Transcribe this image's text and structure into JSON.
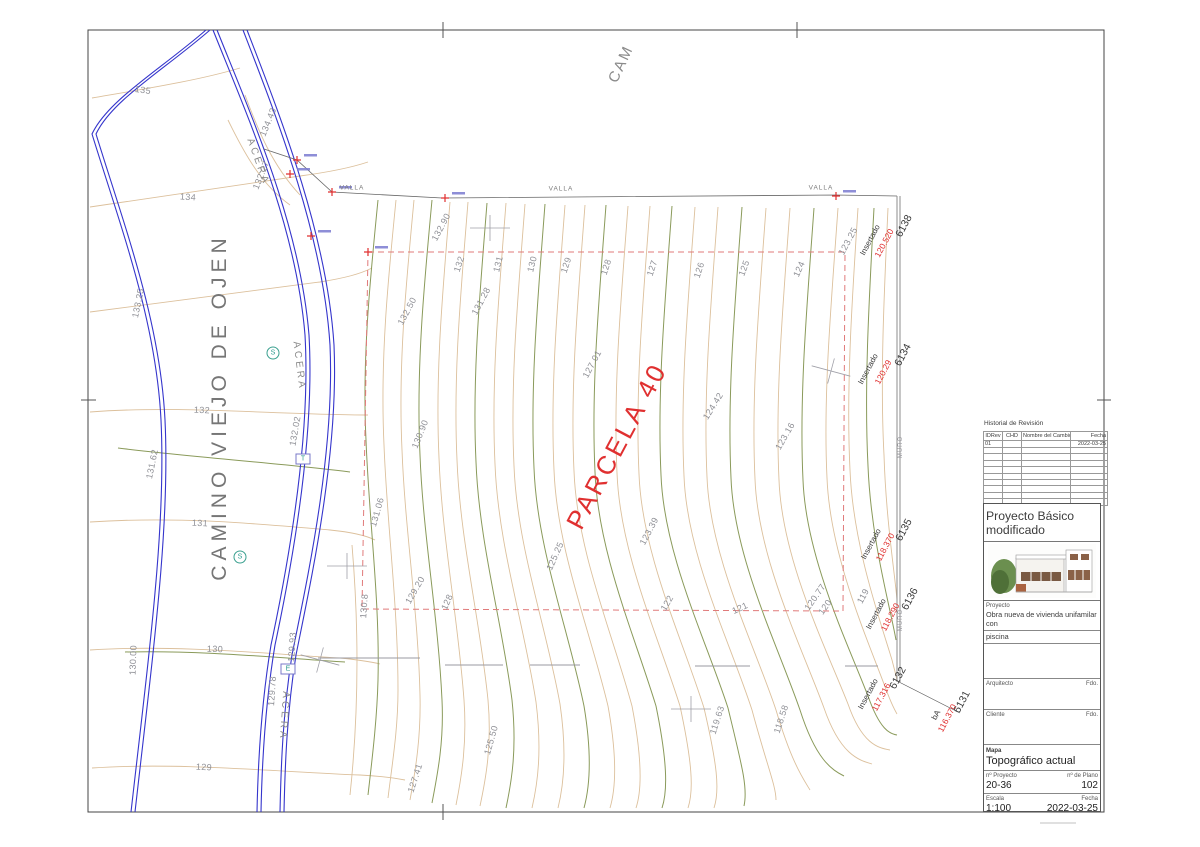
{
  "colors": {
    "contour_minor": "#dcc09c",
    "contour_major": "#8a9a5a",
    "road_blue": "#3535cc",
    "boundary_red": "#e07a7a",
    "red_text": "#e03030",
    "gray_text": "#8f9096"
  },
  "title_block": {
    "revision": {
      "title": "Historial de Revisión",
      "columns": [
        "IDRev",
        "CHD",
        "Nombre del Cambio",
        "Fecha"
      ],
      "row1": {
        "id": "01",
        "chd": "",
        "name": "",
        "date": "2022-03-25"
      }
    },
    "project_title": "Proyecto Básico modificado",
    "project_label": "Proyecto",
    "project_desc_line1": "Obra nueva de vivienda unifamilar con",
    "project_desc_line2": "piscina",
    "architect_label": "Arquitecto",
    "architect_sign": "Fdo.",
    "client_label": "Cliente",
    "client_sign": "Fdo.",
    "sheet_label": "Mapa",
    "sheet_title": "Topográfico actual",
    "project_no_label": "nº Proyecto",
    "project_no": "20-36",
    "plan_no_label": "nº de Plano",
    "plan_no": "102",
    "scale_label": "Escala",
    "scale": "1:100",
    "date_label": "Fecha",
    "date": "2022-03-25"
  },
  "drawing": {
    "parcel_label": "PARCELA 40",
    "road_name": "CAMINO VIEJO DE OJEN",
    "top_road_label": "CAM",
    "sidewalk_labels": [
      {
        "t": "ACERA",
        "x": 258,
        "y": 162,
        "r": 70
      },
      {
        "t": "ACERA",
        "x": 299,
        "y": 366,
        "r": 83
      },
      {
        "t": "ACERA",
        "x": 284,
        "y": 716,
        "r": 94
      }
    ],
    "fence_labels": [
      {
        "t": "VALLA",
        "x": 352,
        "y": 188
      },
      {
        "t": "VALLA",
        "x": 561,
        "y": 189
      },
      {
        "t": "VALLA",
        "x": 821,
        "y": 188
      }
    ],
    "wall_labels": [
      {
        "t": "MURO",
        "x": 901,
        "y": 447,
        "r": -90
      },
      {
        "t": "MURO",
        "x": 901,
        "y": 620,
        "r": -90
      }
    ],
    "contour_labels": [
      {
        "t": "135",
        "x": 143,
        "y": 90,
        "r": 8
      },
      {
        "t": "134",
        "x": 188,
        "y": 197,
        "r": 4
      },
      {
        "t": "134.43",
        "x": 268,
        "y": 122,
        "r": -68
      },
      {
        "t": "132.27",
        "x": 261,
        "y": 175,
        "r": -68
      },
      {
        "t": "133.25",
        "x": 138,
        "y": 303,
        "r": -78
      },
      {
        "t": "132.02",
        "x": 295,
        "y": 431,
        "r": -80
      },
      {
        "t": "132",
        "x": 202,
        "y": 410,
        "r": 3
      },
      {
        "t": "131.62",
        "x": 152,
        "y": 464,
        "r": -78
      },
      {
        "t": "131",
        "x": 200,
        "y": 523,
        "r": 3
      },
      {
        "t": "130",
        "x": 215,
        "y": 649,
        "r": 2
      },
      {
        "t": "130.00",
        "x": 133,
        "y": 660,
        "r": -88
      },
      {
        "t": "129.93",
        "x": 292,
        "y": 647,
        "r": -86
      },
      {
        "t": "129.78",
        "x": 272,
        "y": 691,
        "r": -86
      },
      {
        "t": "129",
        "x": 204,
        "y": 767,
        "r": 3
      },
      {
        "t": "132.90",
        "x": 441,
        "y": 227,
        "r": -62
      },
      {
        "t": "132.50",
        "x": 407,
        "y": 311,
        "r": -62
      },
      {
        "t": "132",
        "x": 459,
        "y": 264,
        "r": -72
      },
      {
        "t": "131.28",
        "x": 481,
        "y": 301,
        "r": -62
      },
      {
        "t": "131",
        "x": 498,
        "y": 264,
        "r": -76
      },
      {
        "t": "130",
        "x": 532,
        "y": 264,
        "r": -76
      },
      {
        "t": "129",
        "x": 566,
        "y": 265,
        "r": -72
      },
      {
        "t": "128",
        "x": 606,
        "y": 267,
        "r": -72
      },
      {
        "t": "127",
        "x": 652,
        "y": 268,
        "r": -72
      },
      {
        "t": "126",
        "x": 699,
        "y": 270,
        "r": -72
      },
      {
        "t": "125",
        "x": 744,
        "y": 268,
        "r": -70
      },
      {
        "t": "124",
        "x": 799,
        "y": 269,
        "r": -66
      },
      {
        "t": "123.25",
        "x": 848,
        "y": 241,
        "r": -62
      },
      {
        "t": "127.01",
        "x": 592,
        "y": 364,
        "r": -62
      },
      {
        "t": "130.90",
        "x": 420,
        "y": 434,
        "r": -68
      },
      {
        "t": "131.06",
        "x": 377,
        "y": 512,
        "r": -74
      },
      {
        "t": "125.25",
        "x": 555,
        "y": 556,
        "r": -66
      },
      {
        "t": "123.39",
        "x": 649,
        "y": 531,
        "r": -62
      },
      {
        "t": "124.42",
        "x": 713,
        "y": 406,
        "r": -58
      },
      {
        "t": "123.16",
        "x": 785,
        "y": 436,
        "r": -60
      },
      {
        "t": "130.8",
        "x": 364,
        "y": 606,
        "r": -86
      },
      {
        "t": "129.20",
        "x": 415,
        "y": 590,
        "r": -60
      },
      {
        "t": "128",
        "x": 447,
        "y": 602,
        "r": -66
      },
      {
        "t": "122",
        "x": 667,
        "y": 603,
        "r": -60
      },
      {
        "t": "121",
        "x": 740,
        "y": 608,
        "r": -25
      },
      {
        "t": "120.77",
        "x": 815,
        "y": 597,
        "r": -55
      },
      {
        "t": "120",
        "x": 825,
        "y": 607,
        "r": -55
      },
      {
        "t": "119",
        "x": 863,
        "y": 596,
        "r": -62
      },
      {
        "t": "119.63",
        "x": 717,
        "y": 720,
        "r": -72
      },
      {
        "t": "118.58",
        "x": 781,
        "y": 719,
        "r": -72
      },
      {
        "t": "125.50",
        "x": 491,
        "y": 740,
        "r": -74
      },
      {
        "t": "127.41",
        "x": 415,
        "y": 778,
        "r": -72
      }
    ],
    "stakes": [
      {
        "name": "Insertado",
        "elev": "120.520",
        "id": "6138",
        "pos": {
          "name": [
            870,
            240
          ],
          "elev": [
            884,
            243
          ],
          "id": [
            904,
            226
          ]
        }
      },
      {
        "name": "Insertado",
        "elev": "120.29",
        "id": "6134",
        "pos": {
          "name": [
            868,
            369
          ],
          "elev": [
            883,
            372
          ],
          "id": [
            903,
            355
          ]
        }
      },
      {
        "name": "Insertado",
        "elev": "118.370",
        "id": "6135",
        "pos": {
          "name": [
            871,
            544
          ],
          "elev": [
            885,
            547
          ],
          "id": [
            904,
            530
          ]
        }
      },
      {
        "name": "Insertado",
        "elev": "118.290",
        "id": "6136",
        "pos": {
          "name": [
            876,
            614
          ],
          "elev": [
            890,
            617
          ],
          "id": [
            910,
            599
          ]
        }
      },
      {
        "name": "Insertado",
        "elev": "117.316",
        "id": "6132",
        "pos": {
          "name": [
            868,
            694
          ],
          "elev": [
            881,
            697
          ],
          "id": [
            898,
            678
          ]
        }
      },
      {
        "name": "bA",
        "elev": "116.370",
        "id": "6131",
        "pos": {
          "name": [
            936,
            715
          ],
          "elev": [
            947,
            718
          ],
          "id": [
            962,
            702
          ]
        }
      }
    ],
    "utility_symbols": [
      {
        "glyph": "S",
        "shape": "circle",
        "x": 273,
        "y": 353
      },
      {
        "glyph": "T",
        "shape": "rect",
        "x": 303,
        "y": 459
      },
      {
        "glyph": "S",
        "shape": "circle",
        "x": 240,
        "y": 557
      },
      {
        "glyph": "E",
        "shape": "rect",
        "x": 288,
        "y": 669
      }
    ],
    "red_markers": [
      [
        297,
        160
      ],
      [
        290,
        174
      ],
      [
        332,
        192
      ],
      [
        311,
        236
      ],
      [
        368,
        252
      ],
      [
        445,
        198
      ],
      [
        836,
        196
      ]
    ],
    "survey_crosses": [
      [
        490,
        228
      ],
      [
        831,
        371
      ],
      [
        347,
        566
      ],
      [
        320,
        660
      ],
      [
        691,
        709
      ]
    ]
  }
}
